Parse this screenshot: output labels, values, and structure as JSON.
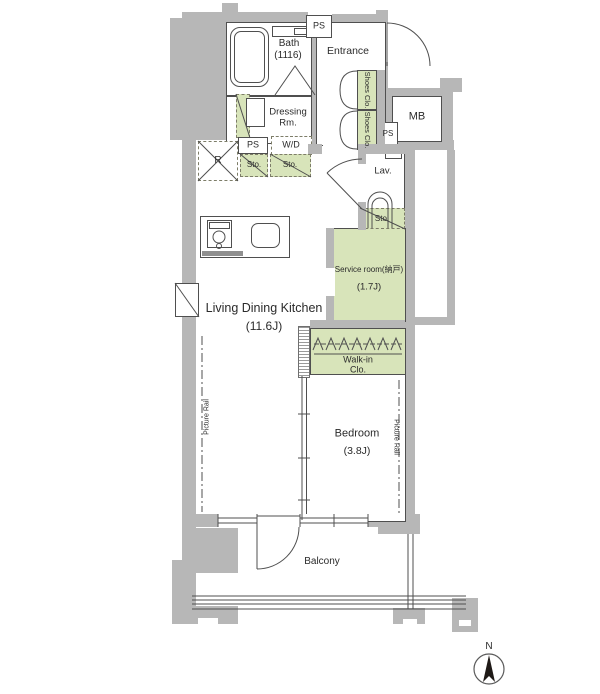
{
  "rooms": {
    "bath": {
      "label": "Bath",
      "size": "(1116)"
    },
    "entrance": {
      "label": "Entrance"
    },
    "dressing": {
      "line1": "Dressing",
      "line2": "Rm."
    },
    "lav": {
      "label": "Lav."
    },
    "ldk": {
      "label": "Living Dining Kitchen",
      "size": "(11.6J)"
    },
    "service": {
      "label": "Service room(納戸)",
      "size": "(1.7J)"
    },
    "walkin": {
      "line1": "Walk-in",
      "line2": "Clo."
    },
    "bedroom": {
      "label": "Bedroom",
      "size": "(3.8J)"
    },
    "balcony": {
      "label": "Balcony"
    },
    "mb": {
      "label": "MB"
    }
  },
  "fixtures": {
    "ps": "PS",
    "wd": "W/D",
    "sto": "Sto.",
    "fridge": "R",
    "shoes_clo": "Shoes Clo.",
    "picture_rail": "Picture Rail"
  },
  "compass": {
    "north": "N"
  },
  "colors": {
    "wall_gray": "#b7b7b7",
    "closet_green": "#d8e4ba",
    "line": "#4f4f4f"
  }
}
